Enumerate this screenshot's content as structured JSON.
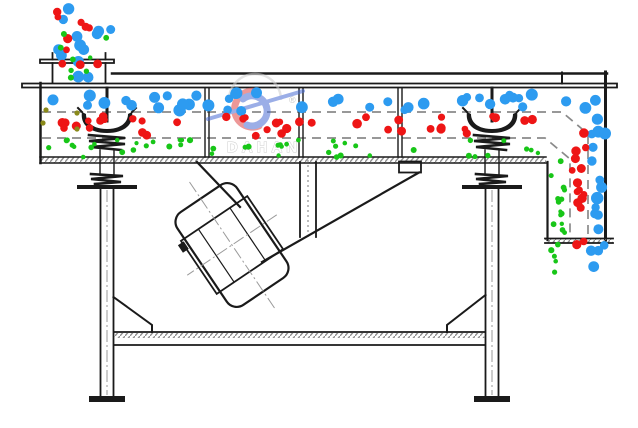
{
  "diagram": {
    "description": "linear vibrating screen cross-section schematic",
    "watermark": {
      "brand": "DAHAN",
      "registered": "®"
    }
  },
  "colors": {
    "line": "#1a1a1a",
    "mesh_dash": "#8a8a8a",
    "blue_particle": "#2d9bf0",
    "red_particle": "#ee1515",
    "green_particle": "#18c618",
    "olive_particle": "#8a8a1a",
    "watermark_red": "#e04545",
    "watermark_blue": "#4a6cd4",
    "watermark_gray": "#c5c5c5"
  },
  "particles": {
    "bands": [
      {
        "name": "feed-stream-blue",
        "color": "blue_particle",
        "x": 54,
        "y": 4,
        "w": 58,
        "h": 86,
        "count": 13,
        "r": 5.2,
        "seed": 11
      },
      {
        "name": "feed-stream-red",
        "color": "red_particle",
        "x": 57,
        "y": 8,
        "w": 52,
        "h": 84,
        "count": 10,
        "r": 4.0,
        "seed": 22
      },
      {
        "name": "feed-stream-green",
        "color": "green_particle",
        "x": 60,
        "y": 12,
        "w": 48,
        "h": 80,
        "count": 8,
        "r": 2.6,
        "seed": 33
      },
      {
        "name": "top-deck-blue",
        "color": "blue_particle",
        "x": 48,
        "y": 92,
        "w": 552,
        "h": 19,
        "count": 41,
        "r": 5.2,
        "seed": 44
      },
      {
        "name": "middle-deck-red",
        "color": "red_particle",
        "x": 46,
        "y": 116,
        "w": 528,
        "h": 20,
        "count": 40,
        "r": 4.0,
        "seed": 55
      },
      {
        "name": "bottom-deck-green",
        "color": "green_particle",
        "x": 44,
        "y": 140,
        "w": 504,
        "h": 17,
        "count": 46,
        "r": 2.6,
        "seed": 66
      },
      {
        "name": "discharge-col-blue",
        "color": "blue_particle",
        "x": 591,
        "y": 112,
        "w": 15,
        "h": 170,
        "count": 17,
        "r": 5.2,
        "seed": 77
      },
      {
        "name": "discharge-col-red",
        "color": "red_particle",
        "x": 572,
        "y": 133,
        "w": 14,
        "h": 158,
        "count": 16,
        "r": 4.0,
        "seed": 88
      },
      {
        "name": "discharge-col-green",
        "color": "green_particle",
        "x": 551,
        "y": 161,
        "w": 14,
        "h": 138,
        "count": 19,
        "r": 2.6,
        "seed": 99
      }
    ],
    "fixed_dots": [
      {
        "color": "olive_particle",
        "x": 46,
        "y": 110,
        "r": 2.6
      },
      {
        "color": "olive_particle",
        "x": 43,
        "y": 123,
        "r": 2.6
      },
      {
        "color": "olive_particle",
        "x": 77,
        "y": 113,
        "r": 2.6
      },
      {
        "color": "olive_particle",
        "x": 77,
        "y": 129,
        "r": 2.6
      }
    ]
  }
}
